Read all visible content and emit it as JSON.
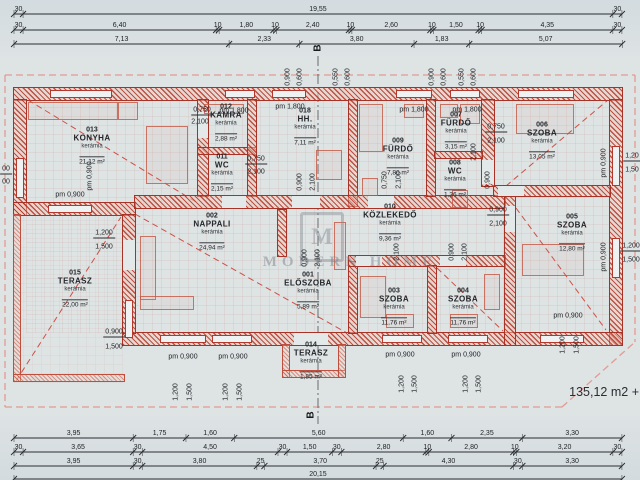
{
  "colors": {
    "paper": "#dee3e4",
    "plan_red": "#c0392b",
    "dash_pink": "#e39b93",
    "line_dark": "#2a2d31",
    "watermark_grey": "#80868d"
  },
  "section_markers": {
    "top": "B",
    "bottom": "B"
  },
  "area_note": "135,12 m2 +",
  "watermark": {
    "logo_letter": "M",
    "text": "MODERN HOME"
  },
  "dim_rows": {
    "origin_x": 14,
    "scale_px_per_m": 30.17,
    "rows": [
      {
        "y": 14,
        "segments": [
          "30",
          "19,55",
          "30"
        ]
      },
      {
        "y": 30,
        "segments": [
          "30",
          "6,40",
          "10",
          "1,80",
          "10",
          "2,40",
          "10",
          "2,60",
          "10",
          "1,50",
          "10",
          "4,35",
          "30"
        ]
      },
      {
        "y": 44,
        "segments": [
          "7,13",
          "2,33",
          "3,80",
          "1,83",
          "5,07"
        ]
      },
      {
        "y": 438,
        "segments": [
          "3,95",
          "1,75",
          "1,60",
          "5,60",
          "1,60",
          "2,35",
          "3,30"
        ]
      },
      {
        "y": 452,
        "segments": [
          "30",
          "3,65",
          "30",
          "4,50",
          "30",
          "1,50",
          "30",
          "2,80",
          "10",
          "2,80",
          "10",
          "3,20",
          "30"
        ]
      },
      {
        "y": 466,
        "segments": [
          "3,95",
          "30",
          "3,80",
          "25",
          "3,70",
          "25",
          "4,30",
          "30",
          "3,30"
        ]
      },
      {
        "y": 479,
        "segments": [
          "20,15"
        ]
      }
    ]
  },
  "rooms": [
    {
      "num": "013",
      "name": "KONYHA",
      "mat": "kerámia",
      "area": "21,12 m²",
      "cx": 92,
      "cy": 147
    },
    {
      "num": "012",
      "name": "KAMRA",
      "mat": "kerámia",
      "area": "2,88 m²",
      "cx": 226,
      "cy": 124
    },
    {
      "num": "011",
      "name": "WC",
      "mat": "kerámia",
      "area": "2,15 m²",
      "cx": 222,
      "cy": 174
    },
    {
      "num": "018",
      "name": "HH.",
      "mat": "kerámia",
      "area": "7,11 m²",
      "cx": 305,
      "cy": 128
    },
    {
      "num": "009",
      "name": "FÜRDŐ",
      "mat": "kerámia",
      "area": "7,80 m²",
      "cx": 398,
      "cy": 158
    },
    {
      "num": "007",
      "name": "FÜRDŐ",
      "mat": "kerámia",
      "area": "3,15 m²",
      "cx": 456,
      "cy": 132
    },
    {
      "num": "008",
      "name": "WC",
      "mat": "kerámia",
      "area": "1,36 m²",
      "cx": 455,
      "cy": 180
    },
    {
      "num": "006",
      "name": "SZOBA",
      "mat": "kerámia",
      "area": "13,05 m²",
      "cx": 542,
      "cy": 142
    },
    {
      "num": "002",
      "name": "NAPPALI",
      "mat": "kerámia",
      "area": "24,94 m²",
      "cx": 212,
      "cy": 233
    },
    {
      "num": "010",
      "name": "KÖZLEKEDŐ",
      "mat": "kerámia",
      "area": "9,36 m²",
      "cx": 390,
      "cy": 224
    },
    {
      "num": "005",
      "name": "SZOBA",
      "mat": "kerámia",
      "area": "12,80 m²",
      "cx": 572,
      "cy": 234
    },
    {
      "num": "001",
      "name": "ELŐSZOBA",
      "mat": "kerámia",
      "area": "5,89 m²",
      "cx": 308,
      "cy": 292
    },
    {
      "num": "003",
      "name": "SZOBA",
      "mat": "kerámia",
      "area": "11,76 m²",
      "cx": 394,
      "cy": 308
    },
    {
      "num": "004",
      "name": "SZOBA",
      "mat": "kerámia",
      "area": "11,76 m²",
      "cx": 463,
      "cy": 308
    },
    {
      "num": "015",
      "name": "TERASZ",
      "mat": "kerámia",
      "area": "22,00 m²",
      "cx": 75,
      "cy": 290
    },
    {
      "num": "014",
      "name": "TERASZ",
      "mat": "kerámia",
      "area": "1,85 m²",
      "cx": 311,
      "cy": 362
    }
  ],
  "dim_labels": [
    {
      "t": "0,750",
      "x": 202,
      "y": 111,
      "ul": 1
    },
    {
      "t": "2,100",
      "x": 200,
      "y": 122
    },
    {
      "t": "pm 1,800",
      "x": 234,
      "y": 111
    },
    {
      "t": "pm 1,800",
      "x": 290,
      "y": 107
    },
    {
      "t": "pm 1,800",
      "x": 414,
      "y": 110
    },
    {
      "t": "pm 1,800",
      "x": 467,
      "y": 110
    },
    {
      "t": "0,750",
      "x": 496,
      "y": 128,
      "ul": 1
    },
    {
      "t": "2,100",
      "x": 496,
      "y": 141
    },
    {
      "t": "0,750",
      "x": 256,
      "y": 160,
      "ul": 1
    },
    {
      "t": "2,100",
      "x": 256,
      "y": 172
    },
    {
      "t": "pm 0,900",
      "x": 70,
      "y": 195
    },
    {
      "t": "1,200",
      "x": 104,
      "y": 234,
      "ul": 1
    },
    {
      "t": "1,500",
      "x": 104,
      "y": 247
    },
    {
      "t": "0,900",
      "x": 498,
      "y": 211,
      "ul": 1
    },
    {
      "t": "2,100",
      "x": 498,
      "y": 224
    },
    {
      "t": "0,900",
      "x": 114,
      "y": 333,
      "ul": 1
    },
    {
      "t": "1,500",
      "x": 114,
      "y": 347
    },
    {
      "t": "pm 0,900",
      "x": 183,
      "y": 357
    },
    {
      "t": "pm 0,900",
      "x": 233,
      "y": 357
    },
    {
      "t": "pm 0,900",
      "x": 400,
      "y": 355
    },
    {
      "t": "pm 0,900",
      "x": 466,
      "y": 355
    },
    {
      "t": "pm 0,900",
      "x": 568,
      "y": 316
    },
    {
      "t": "1,20",
      "x": 632,
      "y": 157,
      "ul": 1
    },
    {
      "t": "1,50",
      "x": 632,
      "y": 170
    },
    {
      "t": "1,200",
      "x": 631,
      "y": 247,
      "ul": 1
    },
    {
      "t": "1,500",
      "x": 631,
      "y": 260
    },
    {
      "t": "00",
      "x": 6,
      "y": 170,
      "ul": 1
    },
    {
      "t": "00",
      "x": 6,
      "y": 182
    },
    {
      "t": "0,900",
      "x": 288,
      "y": 77,
      "rot": 1
    },
    {
      "t": "0,600",
      "x": 300,
      "y": 77,
      "rot": 1
    },
    {
      "t": "0,550",
      "x": 336,
      "y": 77,
      "rot": 1
    },
    {
      "t": "0,600",
      "x": 348,
      "y": 77,
      "rot": 1
    },
    {
      "t": "0,900",
      "x": 432,
      "y": 77,
      "rot": 1
    },
    {
      "t": "0,600",
      "x": 444,
      "y": 77,
      "rot": 1
    },
    {
      "t": "0,550",
      "x": 462,
      "y": 77,
      "rot": 1
    },
    {
      "t": "0,600",
      "x": 474,
      "y": 77,
      "rot": 1
    },
    {
      "t": "pm 0,900",
      "x": 90,
      "y": 176,
      "rot": 1
    },
    {
      "t": "0,900",
      "x": 300,
      "y": 182,
      "rot": 1
    },
    {
      "t": "2,100",
      "x": 313,
      "y": 182,
      "rot": 1
    },
    {
      "t": "0,750",
      "x": 385,
      "y": 180,
      "rot": 1
    },
    {
      "t": "2,100",
      "x": 399,
      "y": 180,
      "rot": 1
    },
    {
      "t": "2,100",
      "x": 474,
      "y": 152,
      "rot": 1
    },
    {
      "t": "0,900",
      "x": 488,
      "y": 180,
      "rot": 1
    },
    {
      "t": "0,900",
      "x": 305,
      "y": 258,
      "rot": 1
    },
    {
      "t": "2,100",
      "x": 318,
      "y": 258,
      "rot": 1
    },
    {
      "t": "2,100",
      "x": 397,
      "y": 252,
      "rot": 1
    },
    {
      "t": "0,900",
      "x": 452,
      "y": 252,
      "rot": 1
    },
    {
      "t": "2,100",
      "x": 465,
      "y": 252,
      "rot": 1
    },
    {
      "t": "pm 0,900",
      "x": 604,
      "y": 163,
      "rot": 1
    },
    {
      "t": "pm 0,900",
      "x": 604,
      "y": 257,
      "rot": 1
    },
    {
      "t": "1,200",
      "x": 176,
      "y": 392,
      "rot": 1
    },
    {
      "t": "1,500",
      "x": 190,
      "y": 392,
      "rot": 1
    },
    {
      "t": "1,200",
      "x": 226,
      "y": 392,
      "rot": 1
    },
    {
      "t": "1,500",
      "x": 240,
      "y": 392,
      "rot": 1
    },
    {
      "t": "1,200",
      "x": 402,
      "y": 384,
      "rot": 1
    },
    {
      "t": "1,500",
      "x": 415,
      "y": 384,
      "rot": 1
    },
    {
      "t": "1,200",
      "x": 466,
      "y": 384,
      "rot": 1
    },
    {
      "t": "1,500",
      "x": 479,
      "y": 384,
      "rot": 1
    },
    {
      "t": "1,200",
      "x": 563,
      "y": 345,
      "rot": 1
    },
    {
      "t": "1,500",
      "x": 577,
      "y": 345,
      "rot": 1
    }
  ]
}
